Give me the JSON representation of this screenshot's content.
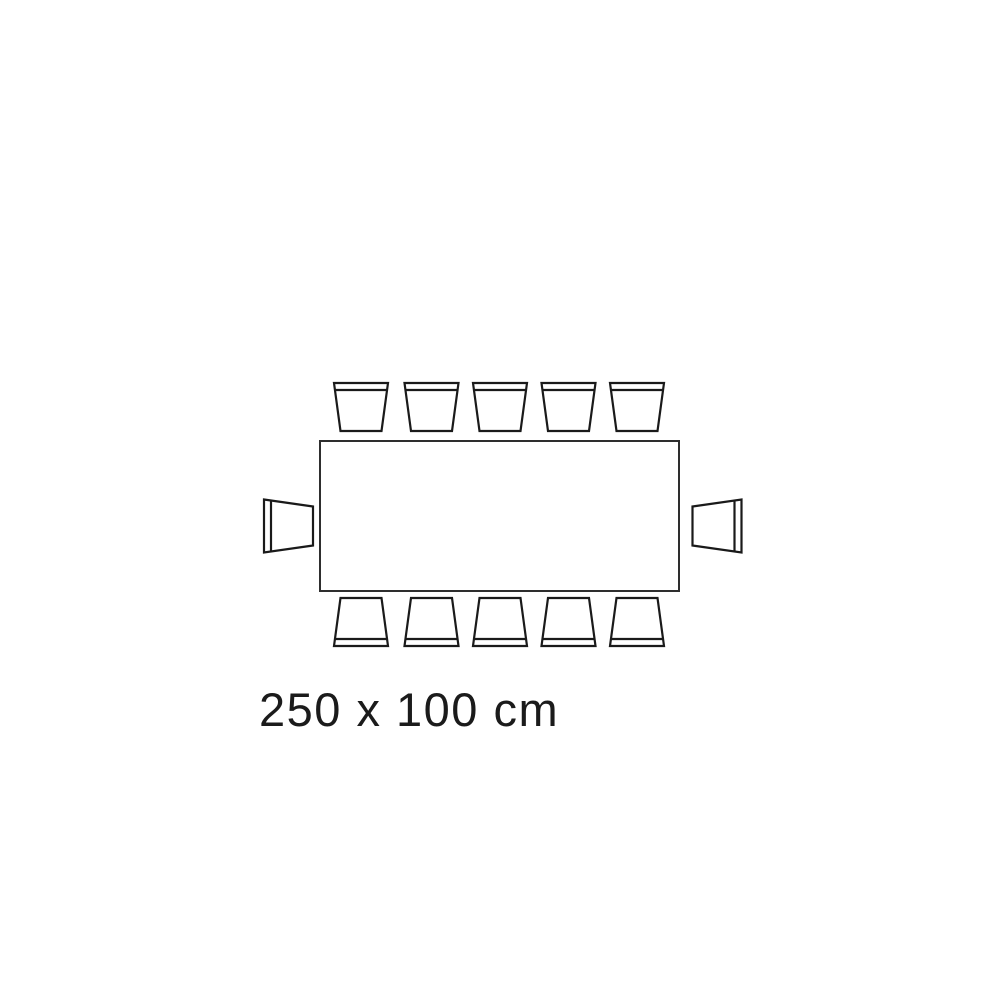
{
  "colors": {
    "background": "#ffffff",
    "table_stroke": "#2e2e2e",
    "chair_stroke": "#1a1a1a",
    "fill": "#ffffff",
    "text": "#1b1b1b"
  },
  "label": {
    "text": "250 x 100 cm"
  },
  "diagram": {
    "type": "table-seating-plan-top-view",
    "table_size_cm": "250 x 100 cm",
    "seat_count": 12,
    "table": {
      "x": 320,
      "y": 441,
      "width": 359,
      "height": 150,
      "stroke_width": 2
    },
    "chair_geometry": {
      "wide": 54,
      "narrow": 41,
      "depth": 48,
      "back_offset": 7,
      "stroke_width": 2.2
    },
    "side_chair_geometry": {
      "wide": 53,
      "narrow": 39,
      "depth": 49,
      "back_offset": 7,
      "stroke_width": 2.2
    },
    "chairs": [
      {
        "side": "top",
        "cx": 361,
        "cy": 407
      },
      {
        "side": "top",
        "cx": 431.5,
        "cy": 407
      },
      {
        "side": "top",
        "cx": 500,
        "cy": 407
      },
      {
        "side": "top",
        "cx": 568.5,
        "cy": 407
      },
      {
        "side": "top",
        "cx": 637,
        "cy": 407
      },
      {
        "side": "bottom",
        "cx": 361,
        "cy": 622
      },
      {
        "side": "bottom",
        "cx": 431.5,
        "cy": 622
      },
      {
        "side": "bottom",
        "cx": 500,
        "cy": 622
      },
      {
        "side": "bottom",
        "cx": 568.5,
        "cy": 622
      },
      {
        "side": "bottom",
        "cx": 637,
        "cy": 622
      },
      {
        "side": "left",
        "cx": 288.5,
        "cy": 526
      },
      {
        "side": "right",
        "cx": 717,
        "cy": 526
      }
    ]
  }
}
